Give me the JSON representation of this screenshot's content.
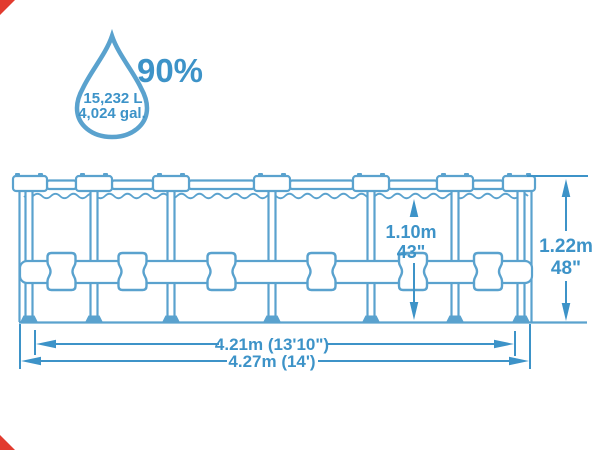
{
  "colors": {
    "line": "#5AA2CE",
    "dim": "#3D93C8",
    "red": "#E23B2E"
  },
  "drop": {
    "percent": "90%",
    "liters": "15,232 L",
    "gallons": "4,024 gal."
  },
  "dims": {
    "depth_m": "1.10m",
    "depth_in": "43\"",
    "height_m": "1.22m",
    "height_in": "48\"",
    "top_width": "4.21m (13'10\")",
    "bottom_width": "4.27m (14')"
  },
  "icons": {
    "drop": "water-drop-icon"
  }
}
